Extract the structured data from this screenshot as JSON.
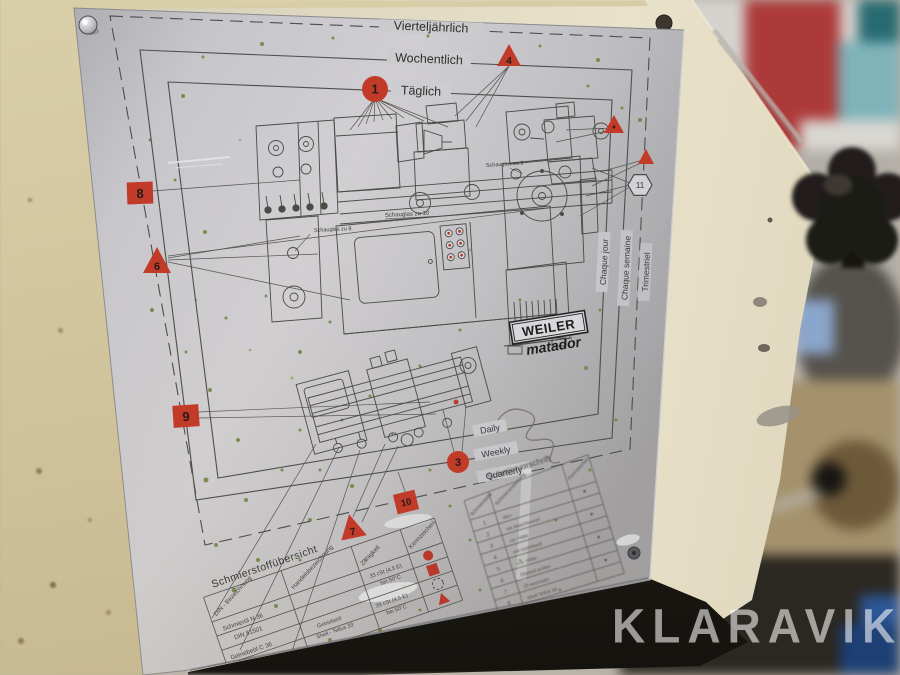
{
  "photo": {
    "watermark": "KLARAVIK"
  },
  "plate": {
    "schedule_rings": {
      "daily_de": "Täglich",
      "weekly_de": "Wochentlich",
      "quarterly_de": "Vierteljährlich",
      "daily_fr": "Chaque jour",
      "weekly_fr": "Chaque semaine",
      "quarterly_fr": "Trimestriel",
      "daily_en": "Daily",
      "weekly_en": "Weekly",
      "quarterly_en": "Quarterly"
    },
    "markers": {
      "point_1": "1",
      "point_3": "3",
      "point_4": "4",
      "point_6": "6",
      "point_7": "7",
      "point_8": "8",
      "point_9": "9",
      "point_10": "10",
      "point_11": "11"
    },
    "diagram_labels": {
      "sight_glass_10": "Schauglas zu 10",
      "sight_glass_8": "Schauglas zu 8",
      "sight_glass_9": "Schauglas zu 9"
    },
    "logo": {
      "brand": "WEILER",
      "model": "matador"
    },
    "oil_table": {
      "title": "Schmierstoffübersicht",
      "columns": [
        "DIN - Bezeichnung",
        "Handelsbezeichnung",
        "Zähigkeit",
        "Kennzeichen"
      ],
      "rows": [
        {
          "din_1": "Schmieröl N 36",
          "din_2": "DIN 51501",
          "brand_1": "",
          "brand_2": "",
          "visc_1": "33 cSt (4,5 E)",
          "visc_2": "bei 50°C"
        },
        {
          "din_1": "Getriebeöl C 36",
          "din_2": "DIN 51517",
          "brand_1": "Getriebeöl",
          "brand_2": "Shell - Tellus 33",
          "visc_1": "39 cSt (4,5 E)",
          "visc_2": "bei 50°C"
        }
      ]
    },
    "schedule_table": {
      "title": "Schmiervorschrift",
      "columns": [
        "Schmierstelle",
        "Schmieranweisung",
        "Kennzeichen"
      ],
      "rows": [
        {
          "n": "1",
          "text": "ölen"
        },
        {
          "n": "2",
          "text": "mit Maschinenöl"
        },
        {
          "n": "3",
          "text": "ca. Hübe"
        },
        {
          "n": "4",
          "text": "mit Getriebeöl"
        },
        {
          "n": "5",
          "text": "n.b. Hübe"
        },
        {
          "n": "6",
          "text": "Ölstand prüfen"
        },
        {
          "n": "7",
          "text": "Öl wechseln"
        },
        {
          "n": "8",
          "text": "Shell Tellus 33"
        }
      ]
    }
  },
  "colors": {
    "marker_red": "#c0392b",
    "plate_metal": "#c6c5c9",
    "machine_cream": "#ddd6bf",
    "floor_tan": "#cfc097"
  }
}
